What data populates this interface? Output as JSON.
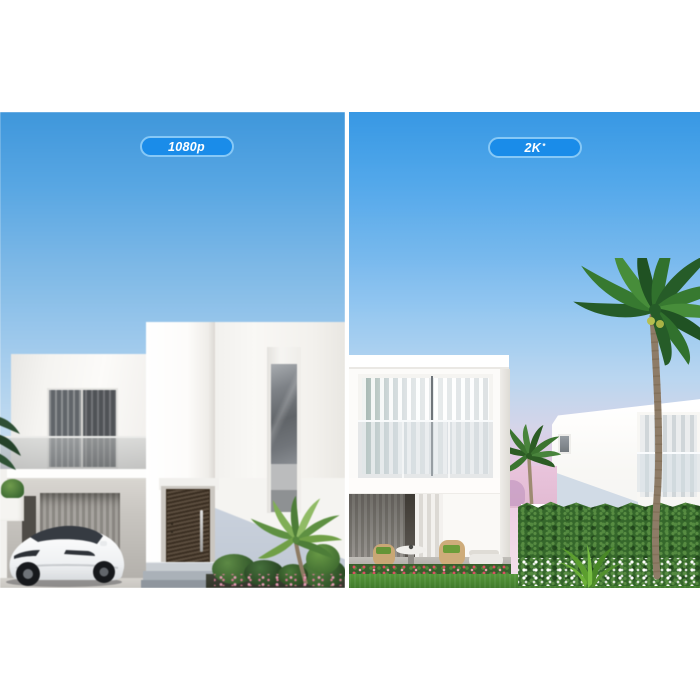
{
  "badges": {
    "left": {
      "text": "1080p",
      "sup": ""
    },
    "right": {
      "text": "2K",
      "sup": "*"
    }
  },
  "colors": {
    "background": "#ffffff",
    "divider": "#ffffff",
    "badge_fill": "#1a8ce9",
    "badge_border": "#86c8f6",
    "badge_text": "#ffffff",
    "sky_top": "#3d97de",
    "sky_horizon_left": "#e4ecf3",
    "sky_horizon_right_pink": "#eccfe2"
  }
}
